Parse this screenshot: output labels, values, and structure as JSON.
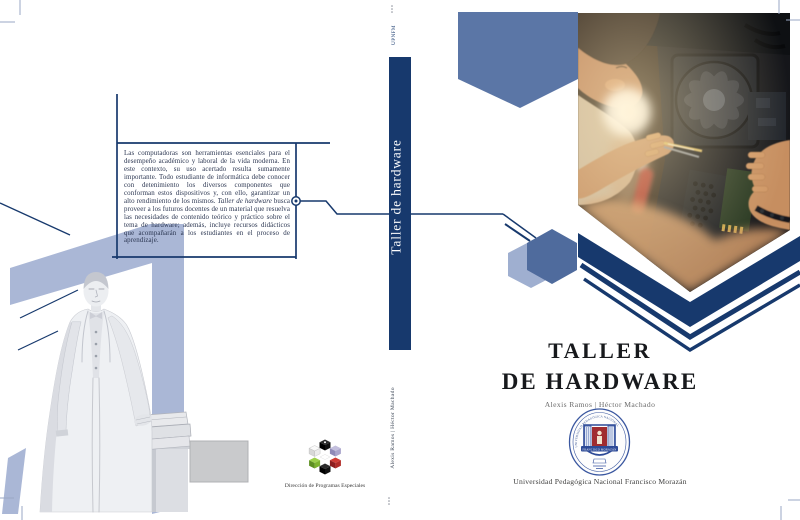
{
  "back_cover": {
    "blurb": {
      "before": "Las computadoras son herramientas esenciales para el desempeño académico y laboral de la vida moderna. En este contexto, su uso acertado resulta sumamente importante. Todo estudiante de informática debe conocer con detenimiento los diversos componentes que conforman estos dispositivos y, con ello, garantizar un alto rendimiento de los mismos. ",
      "italic_phrase": "Taller de hardware",
      "after": " busca proveer a los futuros docentes de un material que resuelva las necesidades de contenido teórico y práctico sobre el tema de hardware; además, incluye recursos didácticos que acompañarán a los estudiantes en el proceso de aprendizaje."
    },
    "dpe_label": "Dirección de Programas Especiales"
  },
  "spine": {
    "publisher_abbrev": "UPNFM",
    "title": "Taller de hardware",
    "authors": "Alexis Ramos | Héctor Machado"
  },
  "front_cover": {
    "title_line1": "TALLER",
    "title_line2": "DE HARDWARE",
    "authors": "Alexis Ramos | Héctor Machado",
    "university_name": "Universidad Pedagógica Nacional Francisco Morazán",
    "seal": {
      "arc_text": "UNIVERSIDAD PEDAGÓGICA NACIONAL",
      "banner_text": "FRANCISCO MORAZÁN"
    }
  },
  "colors": {
    "navy": "#17396d",
    "slate_blue": "#5b76a6",
    "periwinkle": "#aab7d6",
    "title_ink": "#17191c"
  }
}
